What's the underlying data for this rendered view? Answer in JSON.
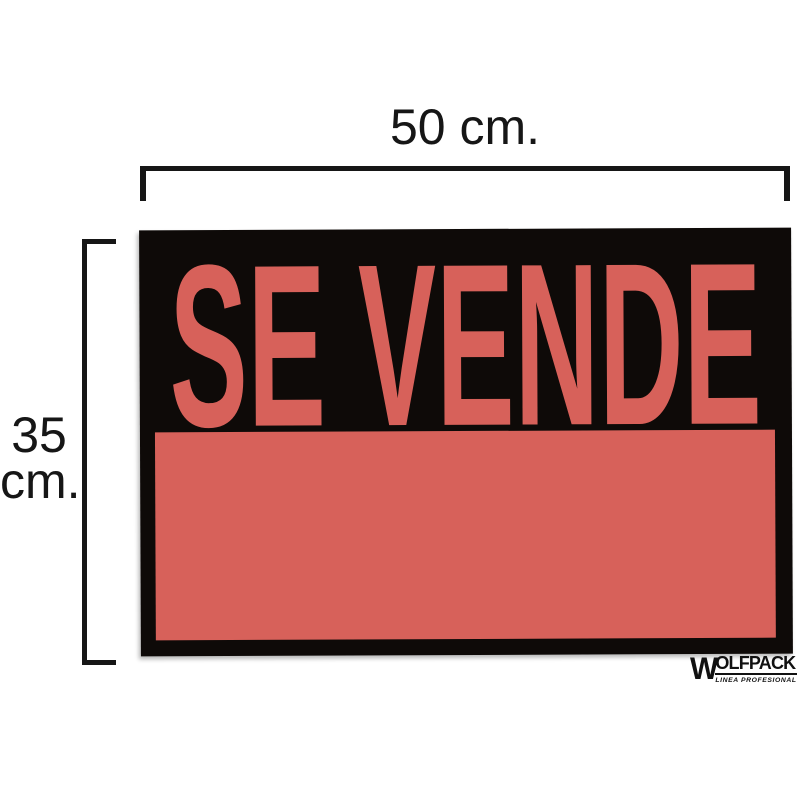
{
  "dimensions": {
    "width_label": "50 cm.",
    "height_label_value": "35",
    "height_label_unit": "cm."
  },
  "sign": {
    "headline": "SE VENDE"
  },
  "brand": {
    "wordmark_initial": "W",
    "wordmark_rest": "OLFPACK",
    "tagline": "LINEA PROFESIONAL"
  },
  "colors": {
    "background": "#ffffff",
    "sign_black": "#0e0a08",
    "sign_red": "#d7615a",
    "dimension_line": "#161616",
    "logo_black": "#111111"
  }
}
